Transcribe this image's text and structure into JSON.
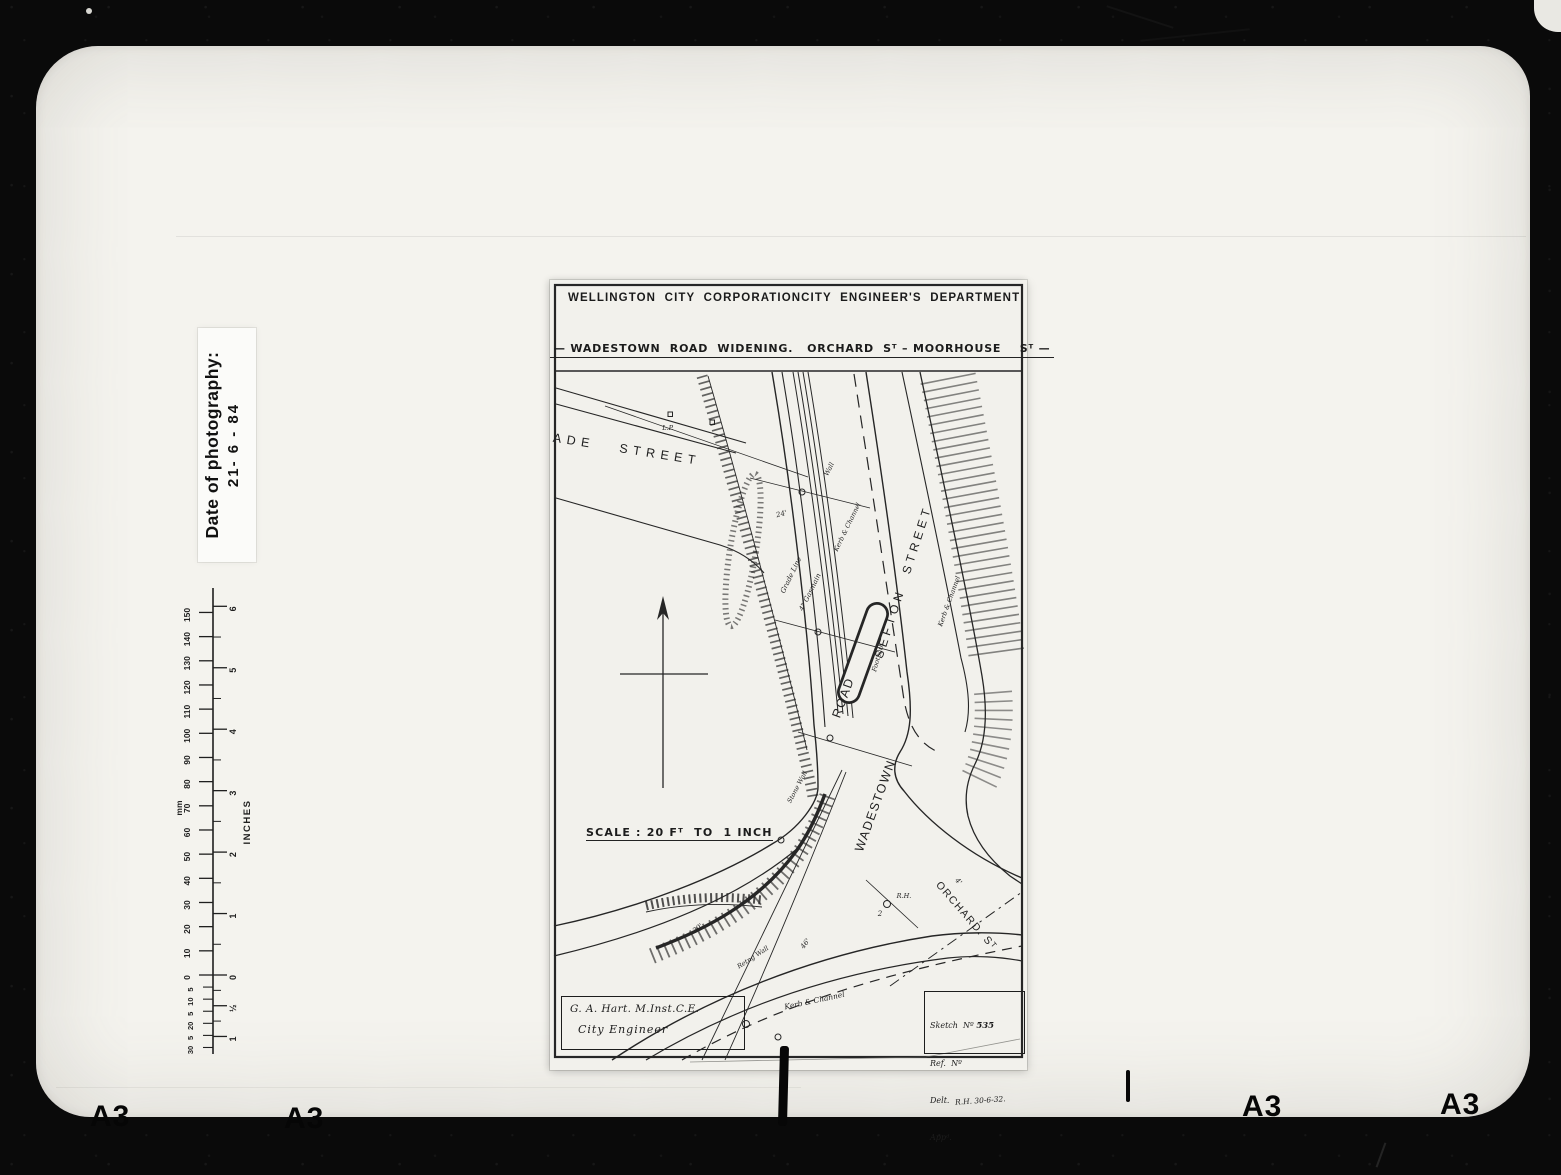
{
  "photo": {
    "date_label": {
      "line1": "Date of photography:",
      "line2": "21- 6 - 84"
    },
    "frame_marks": {
      "bl1": "A3",
      "bl2": "A3",
      "br1": "A3",
      "br2": "A3"
    }
  },
  "ruler": {
    "mm_unit": "mm",
    "inch_unit": "INCHES",
    "mm_labels": [
      "150",
      "140",
      "130",
      "120",
      "110",
      "100",
      "90",
      "80",
      "70",
      "60",
      "50",
      "40",
      "30",
      "20",
      "10",
      "0"
    ],
    "mm_sub_labels": [
      "5",
      "10",
      "5",
      "20",
      "5",
      "30"
    ],
    "inch_labels": [
      "6",
      "5",
      "4",
      "3",
      "2",
      "1",
      "0"
    ],
    "inch_sub_labels": [
      "½",
      "1"
    ]
  },
  "drawing": {
    "header_left": "WELLINGTON  CITY  CORPORATION",
    "header_right": "CITY  ENGINEER'S  DEPARTMENT",
    "subtitle": "— WADESTOWN  ROAD  WIDENING.   ORCHARD  Sᵀ – MOORHOUSE    Sᵀ —",
    "scale_text": "SCALE : 20 Fᵀ  TO  1 INCH",
    "title_box": {
      "line1": "G. A. Hart.  M.Inst.C.E.",
      "line2": "City  Engineer"
    },
    "sketch_box": {
      "line1_label": "Sketch  Nº ",
      "line1_value": "535",
      "line2": "Ref.  Nº",
      "line3_label": "Delt.  ",
      "line3_value": "R.H. 30-6-32.",
      "line4": "Appᵈ."
    },
    "annotations": [
      {
        "name": "street-label-wade",
        "text": "WADE STREET",
        "x": 68,
        "y": 172,
        "r": 9,
        "s": 12.5,
        "ls": 5.5,
        "ws": 16
      },
      {
        "name": "street-label-sefton",
        "text": "SEFTON STREET",
        "x": 357,
        "y": 303,
        "r": -72,
        "s": 12,
        "ls": 4,
        "ws": 9
      },
      {
        "name": "street-label-road",
        "text": "ROAD",
        "x": 297,
        "y": 419,
        "r": -70,
        "s": 12.5,
        "ls": 1.5
      },
      {
        "name": "street-label-wadestown",
        "text": "WADESTOWN",
        "x": 329,
        "y": 527,
        "r": -70,
        "s": 12.5,
        "ls": 1.5
      },
      {
        "name": "street-label-orchard",
        "text": "ORCHARD. Sᵀ",
        "x": 414,
        "y": 638,
        "r": 49,
        "s": 10.5,
        "ls": 1.5
      },
      {
        "name": "annotation-lp",
        "text": "L.P.",
        "x": 118,
        "y": 150,
        "r": 0,
        "s": 6.5,
        "it": true
      },
      {
        "name": "annotation-grade-line",
        "text": "Grade  Line",
        "x": 243,
        "y": 296,
        "r": -64,
        "s": 7,
        "it": true
      },
      {
        "name": "annotation-gasmain",
        "text": "4\" Gasmain",
        "x": 262,
        "y": 313,
        "r": -64,
        "s": 7,
        "it": true
      },
      {
        "name": "annotation-wall",
        "text": "Wall",
        "x": 281,
        "y": 190,
        "r": -64,
        "s": 6.5,
        "it": true
      },
      {
        "name": "annotation-kerb-channel-upper",
        "text": "Kerb & Channel",
        "x": 299,
        "y": 248,
        "r": -64,
        "s": 6.5,
        "it": true
      },
      {
        "name": "annotation-kerb-channel-sefton",
        "text": "Kerb & Channel",
        "x": 401,
        "y": 322,
        "r": -70,
        "s": 6.5,
        "it": true
      },
      {
        "name": "annotation-footpath",
        "text": "Footpath",
        "x": 330,
        "y": 378,
        "r": -74,
        "s": 6.5,
        "it": true
      },
      {
        "name": "annotation-kerb-channel-bottom",
        "text": "Kerb & Channel",
        "x": 265,
        "y": 723,
        "r": -12,
        "s": 7.5,
        "it": true
      },
      {
        "name": "annotation-retaining-wall",
        "text": "Retng Wall",
        "x": 204,
        "y": 679,
        "r": -33,
        "s": 6.5,
        "it": true
      },
      {
        "name": "annotation-stone-wall",
        "text": "Stone Wall",
        "x": 249,
        "y": 508,
        "r": -62,
        "s": 6.5,
        "it": true
      },
      {
        "name": "dimension-24ft",
        "text": "24'",
        "x": 232,
        "y": 236,
        "r": -15,
        "s": 7,
        "it": true
      },
      {
        "name": "dimension-30ft",
        "text": "30'",
        "x": 149,
        "y": 650,
        "r": -38,
        "s": 7,
        "it": true
      },
      {
        "name": "dimension-46ft",
        "text": "46'",
        "x": 257,
        "y": 665,
        "r": -52,
        "s": 7,
        "it": true
      },
      {
        "name": "dimension-4ft",
        "text": "4'",
        "x": 407,
        "y": 603,
        "r": 45,
        "s": 7,
        "it": true
      },
      {
        "name": "point-label-2",
        "text": "2",
        "x": 330,
        "y": 636,
        "r": 0,
        "s": 7,
        "it": true
      },
      {
        "name": "point-label-rh",
        "text": "R.H.",
        "x": 354,
        "y": 618,
        "r": 0,
        "s": 6.5,
        "it": true
      }
    ]
  }
}
